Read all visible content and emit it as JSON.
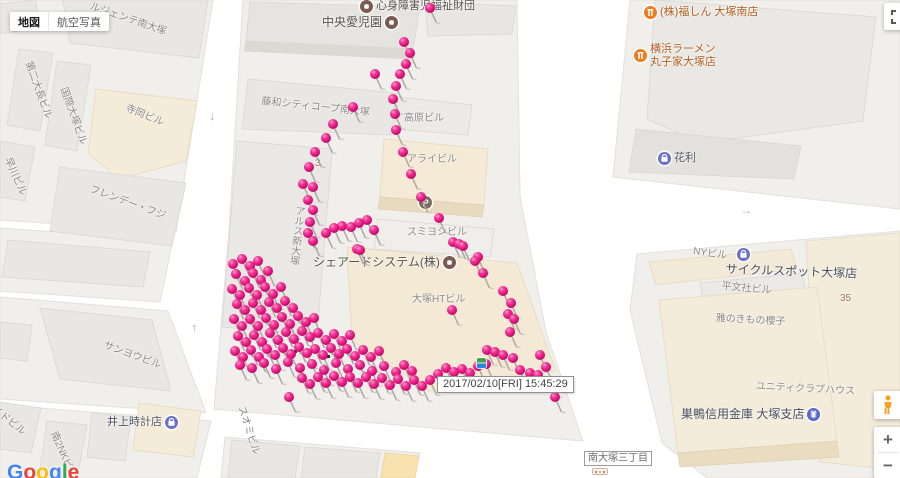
{
  "controls": {
    "map_button": "地図",
    "satellite_button": "航空写真",
    "zoom_in": "+",
    "zoom_out": "−",
    "google_logo": "Google"
  },
  "colors": {
    "pin_pink": "#e2137e",
    "logo_letters": [
      "#4285F4",
      "#EA4335",
      "#FBBC05",
      "#4285F4",
      "#34A853",
      "#EA4335"
    ],
    "poi_civic": "#7b5a50",
    "poi_food": "#ee7b1d",
    "poi_shop": "#6a70c8",
    "poi_bank": "#5566c9",
    "poi_parking": "#7d6c60"
  },
  "tooltip": {
    "text": "2017/02/10[FRI]  15:45:29"
  },
  "district_label": {
    "text": "南大塚三丁目"
  },
  "map": {
    "labels": [
      {
        "text": "ルジェンテ南大塚",
        "x": 92,
        "y": 1,
        "rot": 19,
        "cls": "building"
      },
      {
        "text": "第二大長ビル",
        "x": 33,
        "y": 60,
        "rot": 70,
        "cls": "building"
      },
      {
        "text": "国際大塚ビル",
        "x": 68,
        "y": 86,
        "rot": 70,
        "cls": "building"
      },
      {
        "text": "寺岡ビル",
        "x": 128,
        "y": 103,
        "rot": 22,
        "cls": "building"
      },
      {
        "text": "早川ビル",
        "x": 12,
        "y": 156,
        "rot": 66,
        "cls": "building"
      },
      {
        "text": "フレンデー・フジ",
        "x": 92,
        "y": 184,
        "rot": 20,
        "cls": "building"
      },
      {
        "text": "中央愛児園",
        "x": 322,
        "y": 16,
        "rot": 0,
        "cls": "civic",
        "icon": "civic",
        "iconPos": "right"
      },
      {
        "text": "心身障害児福祉財団",
        "x": 360,
        "y": 0,
        "rot": 0,
        "cls": "civic-sm",
        "icon": "civic",
        "iconPos": "left"
      },
      {
        "text": "藤和シティコープ南大塚",
        "x": 262,
        "y": 96,
        "rot": 6,
        "cls": "building"
      },
      {
        "text": "高原ビル",
        "x": 404,
        "y": 113,
        "rot": 0,
        "cls": "building"
      },
      {
        "text": "アライビル",
        "x": 407,
        "y": 154,
        "rot": 0,
        "cls": "building"
      },
      {
        "text": "スミヨシビル",
        "x": 407,
        "y": 227,
        "rot": 0,
        "cls": "building"
      },
      {
        "text": "アルス新大塚",
        "x": 293,
        "y": 205,
        "rot": 6,
        "cls": "building",
        "vertical": true
      },
      {
        "text": "シェアードシステム(株)",
        "x": 313,
        "y": 256,
        "rot": 0,
        "cls": "civic",
        "icon": "civic",
        "iconPos": "right"
      },
      {
        "text": "大塚HTビル",
        "x": 412,
        "y": 294,
        "rot": 0,
        "cls": "building"
      },
      {
        "text": "3",
        "x": 315,
        "y": 158,
        "rot": 0,
        "cls": "number"
      },
      {
        "text": "35",
        "x": 840,
        "y": 293,
        "rot": 0,
        "cls": "number"
      },
      {
        "text": "(株)福しん 大塚南店",
        "x": 644,
        "y": 6,
        "rot": 0,
        "cls": "food",
        "icon": "food",
        "iconPos": "left"
      },
      {
        "text": "横浜ラーメン\n丸子家大塚店",
        "x": 634,
        "y": 43,
        "rot": 0,
        "cls": "food",
        "icon": "food",
        "iconPos": "left"
      },
      {
        "text": "花利",
        "x": 658,
        "y": 152,
        "rot": 0,
        "cls": "poi",
        "icon": "shop",
        "iconPos": "left"
      },
      {
        "text": "NYビル",
        "x": 694,
        "y": 246,
        "rot": 8,
        "cls": "building"
      },
      {
        "text": "サイクルスポット大塚店",
        "x": 726,
        "y": 263,
        "rot": 2,
        "cls": "poi-lg"
      },
      {
        "text": "平文社ビル",
        "x": 722,
        "y": 281,
        "rot": 5,
        "cls": "building"
      },
      {
        "text": "雅のきもの櫻子",
        "x": 716,
        "y": 313,
        "rot": 3,
        "cls": "building"
      },
      {
        "text": "ユニティクラブハウス",
        "x": 756,
        "y": 381,
        "rot": 3,
        "cls": "building"
      },
      {
        "text": "巣鴨信用金庫 大塚支店",
        "x": 681,
        "y": 408,
        "rot": 0,
        "cls": "poi-lg",
        "icon": "bank",
        "iconPos": "right"
      },
      {
        "text": "井上時計店",
        "x": 107,
        "y": 416,
        "rot": 0,
        "cls": "poi",
        "icon": "shop",
        "iconPos": "right"
      },
      {
        "text": "サンヨウビル",
        "x": 106,
        "y": 340,
        "rot": 20,
        "cls": "building"
      },
      {
        "text": "イドビル",
        "x": -4,
        "y": 404,
        "rot": 38,
        "cls": "building"
      },
      {
        "text": "南2NKビル",
        "x": 58,
        "y": 430,
        "rot": 66,
        "cls": "building"
      },
      {
        "text": "スオミビル",
        "x": 246,
        "y": 405,
        "rot": 72,
        "cls": "building"
      }
    ],
    "standalone_icons": [
      {
        "type": "shop",
        "x": 737,
        "y": 248
      },
      {
        "type": "parking",
        "x": 419,
        "y": 196
      }
    ],
    "arrows": [
      {
        "glyph": "↓",
        "x": 209,
        "y": 108,
        "color": "#b4b2ae",
        "size": 13
      },
      {
        "glyph": "↑",
        "x": 191,
        "y": 320,
        "color": "#9fb0d8",
        "size": 13
      },
      {
        "glyph": "→",
        "x": 740,
        "y": 203,
        "color": "#9fb0d8",
        "size": 12
      }
    ],
    "dots": [
      [
        293,
        350
      ],
      [
        326,
        355
      ],
      [
        363,
        378
      ]
    ],
    "pins": [
      [
        430,
        8
      ],
      [
        404,
        42
      ],
      [
        410,
        53
      ],
      [
        406,
        64
      ],
      [
        400,
        74
      ],
      [
        396,
        86
      ],
      [
        393,
        99
      ],
      [
        395,
        114
      ],
      [
        396,
        130
      ],
      [
        403,
        152
      ],
      [
        411,
        174
      ],
      [
        421,
        197
      ],
      [
        439,
        218
      ],
      [
        459,
        244
      ],
      [
        478,
        257
      ],
      [
        375,
        74
      ],
      [
        353,
        107
      ],
      [
        333,
        124
      ],
      [
        326,
        138
      ],
      [
        315,
        152
      ],
      [
        309,
        167
      ],
      [
        303,
        184
      ],
      [
        313,
        187
      ],
      [
        308,
        200
      ],
      [
        313,
        210
      ],
      [
        310,
        222
      ],
      [
        308,
        233
      ],
      [
        313,
        241
      ],
      [
        326,
        233
      ],
      [
        334,
        228
      ],
      [
        342,
        226
      ],
      [
        351,
        227
      ],
      [
        359,
        223
      ],
      [
        367,
        220
      ],
      [
        374,
        230
      ],
      [
        357,
        249
      ],
      [
        360,
        250
      ],
      [
        453,
        242
      ],
      [
        463,
        246
      ],
      [
        475,
        261
      ],
      [
        483,
        273
      ],
      [
        452,
        310
      ],
      [
        503,
        291
      ],
      [
        511,
        303
      ],
      [
        508,
        314
      ],
      [
        514,
        319
      ],
      [
        510,
        332
      ],
      [
        233,
        264
      ],
      [
        242,
        259
      ],
      [
        250,
        266
      ],
      [
        258,
        261
      ],
      [
        236,
        274
      ],
      [
        245,
        281
      ],
      [
        253,
        273
      ],
      [
        261,
        280
      ],
      [
        268,
        271
      ],
      [
        232,
        289
      ],
      [
        240,
        295
      ],
      [
        249,
        288
      ],
      [
        257,
        295
      ],
      [
        265,
        287
      ],
      [
        273,
        294
      ],
      [
        281,
        287
      ],
      [
        237,
        304
      ],
      [
        245,
        310
      ],
      [
        253,
        303
      ],
      [
        261,
        310
      ],
      [
        269,
        302
      ],
      [
        277,
        308
      ],
      [
        285,
        301
      ],
      [
        293,
        308
      ],
      [
        234,
        319
      ],
      [
        242,
        326
      ],
      [
        250,
        319
      ],
      [
        258,
        326
      ],
      [
        266,
        318
      ],
      [
        274,
        325
      ],
      [
        282,
        317
      ],
      [
        290,
        324
      ],
      [
        298,
        316
      ],
      [
        306,
        322
      ],
      [
        314,
        318
      ],
      [
        238,
        336
      ],
      [
        246,
        342
      ],
      [
        254,
        335
      ],
      [
        262,
        342
      ],
      [
        270,
        333
      ],
      [
        278,
        340
      ],
      [
        286,
        332
      ],
      [
        294,
        339
      ],
      [
        302,
        331
      ],
      [
        310,
        337
      ],
      [
        318,
        333
      ],
      [
        326,
        340
      ],
      [
        334,
        334
      ],
      [
        342,
        341
      ],
      [
        350,
        335
      ],
      [
        235,
        351
      ],
      [
        243,
        357
      ],
      [
        251,
        350
      ],
      [
        259,
        357
      ],
      [
        267,
        349
      ],
      [
        275,
        355
      ],
      [
        283,
        348
      ],
      [
        291,
        354
      ],
      [
        299,
        347
      ],
      [
        307,
        353
      ],
      [
        315,
        349
      ],
      [
        323,
        355
      ],
      [
        331,
        348
      ],
      [
        339,
        354
      ],
      [
        347,
        349
      ],
      [
        355,
        356
      ],
      [
        363,
        350
      ],
      [
        371,
        357
      ],
      [
        379,
        351
      ],
      [
        240,
        365
      ],
      [
        252,
        368
      ],
      [
        264,
        363
      ],
      [
        276,
        369
      ],
      [
        288,
        362
      ],
      [
        300,
        368
      ],
      [
        312,
        364
      ],
      [
        324,
        370
      ],
      [
        336,
        363
      ],
      [
        348,
        369
      ],
      [
        360,
        365
      ],
      [
        372,
        371
      ],
      [
        384,
        366
      ],
      [
        396,
        372
      ],
      [
        404,
        365
      ],
      [
        412,
        371
      ],
      [
        289,
        397
      ],
      [
        302,
        378
      ],
      [
        310,
        384
      ],
      [
        318,
        377
      ],
      [
        326,
        383
      ],
      [
        334,
        376
      ],
      [
        342,
        382
      ],
      [
        350,
        377
      ],
      [
        358,
        383
      ],
      [
        366,
        377
      ],
      [
        374,
        384
      ],
      [
        382,
        378
      ],
      [
        390,
        385
      ],
      [
        398,
        379
      ],
      [
        406,
        386
      ],
      [
        414,
        380
      ],
      [
        422,
        386
      ],
      [
        430,
        380
      ],
      [
        438,
        374
      ],
      [
        446,
        368
      ],
      [
        454,
        372
      ],
      [
        462,
        369
      ],
      [
        470,
        373
      ],
      [
        478,
        366
      ],
      [
        486,
        364
      ],
      [
        487,
        350
      ],
      [
        495,
        352
      ],
      [
        503,
        355
      ],
      [
        513,
        358
      ],
      [
        520,
        370
      ],
      [
        530,
        373
      ],
      [
        538,
        375
      ],
      [
        540,
        355
      ],
      [
        546,
        367
      ],
      [
        552,
        382
      ],
      [
        555,
        397
      ]
    ]
  }
}
